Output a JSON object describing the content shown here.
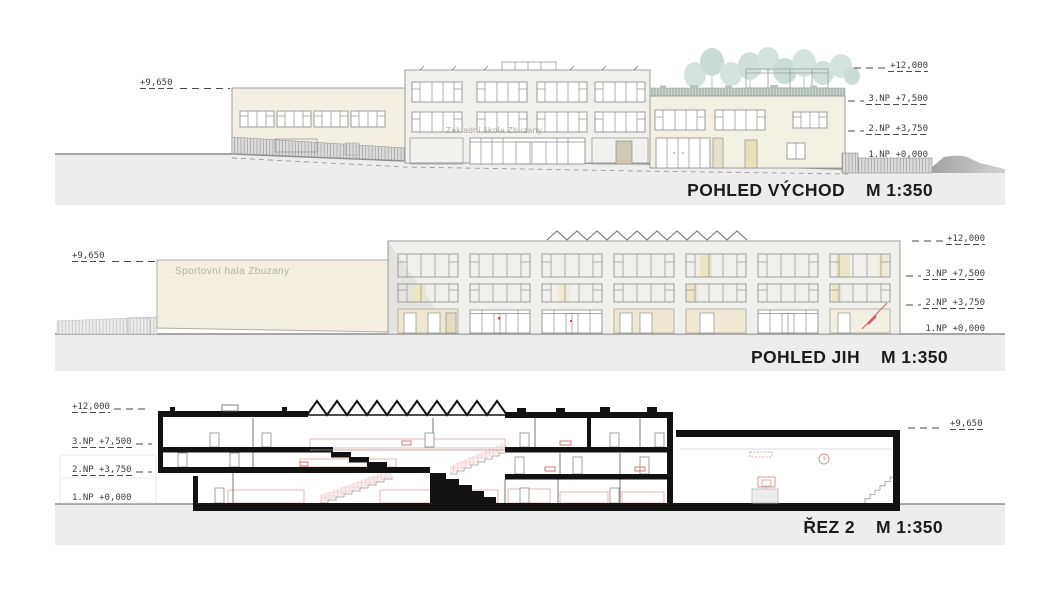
{
  "panels": [
    {
      "id": "east-elevation",
      "title": "POHLED VÝCHOD",
      "scale": "M 1:350",
      "left_level": "+9,650",
      "levels": [
        "+12,000",
        "3.NP +7,500",
        "2.NP +3,750",
        "1.NP +0,000"
      ],
      "building_sign": "Základní škola Zbuzany"
    },
    {
      "id": "south-elevation",
      "title": "POHLED JIH",
      "scale": "M 1:350",
      "left_level": "+9,650",
      "levels": [
        "+12,000",
        "3.NP +7,500",
        "2.NP +3,750",
        "1.NP +0,000"
      ],
      "building_sign": "Sportovní hala Zbuzany"
    },
    {
      "id": "section-2",
      "title": "ŘEZ 2",
      "scale": "M 1:350",
      "right_level": "+9,650",
      "levels": [
        "+12,000",
        "3.NP +7,500",
        "2.NP +3,750",
        "1.NP +0,000"
      ]
    }
  ],
  "colors": {
    "ground_band": "#ededed",
    "facade_cream": "#f3f0e3",
    "facade_light": "#f1f1ee",
    "window_tint": "#ece5c6",
    "tree_green": "#d5e3de",
    "section_poche": "#121212",
    "accent_red": "#cf5f5f",
    "pink_hatch": "#e2a6a4"
  }
}
